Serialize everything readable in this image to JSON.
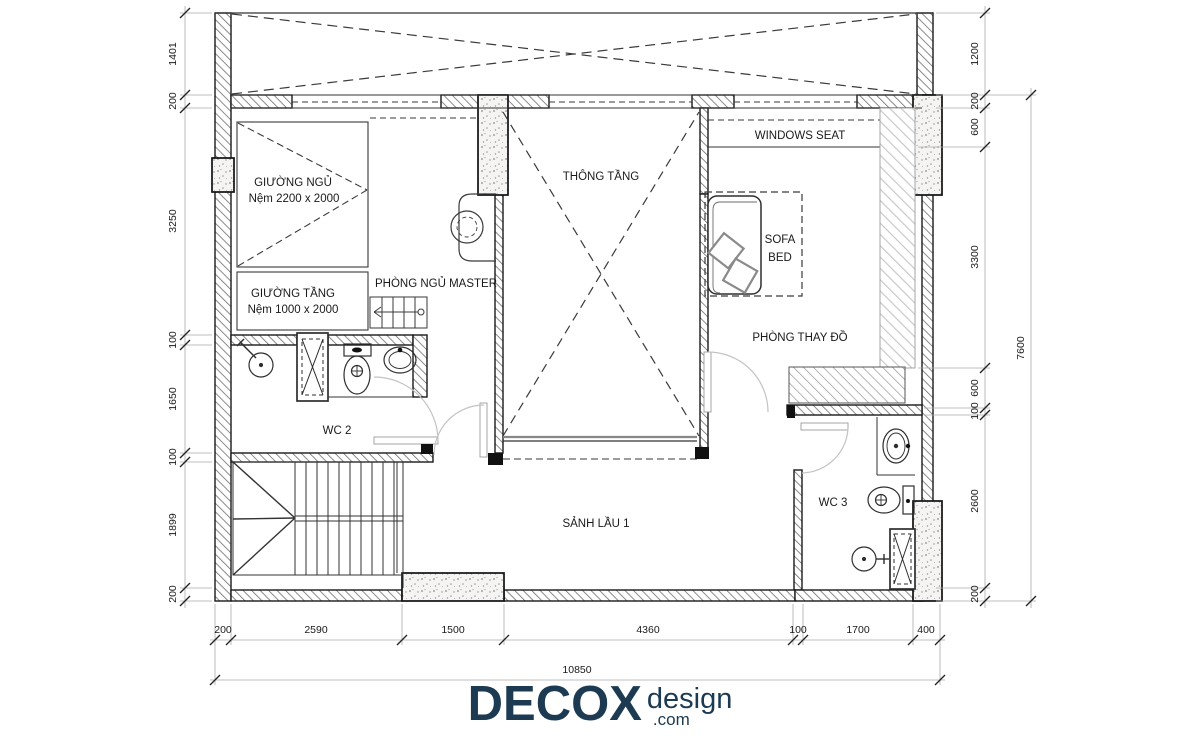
{
  "plan": {
    "rooms": {
      "master_bed": {
        "label": "GIƯỜNG NGỦ",
        "sub": "Nệm 2200 x 2000"
      },
      "bunk_bed": {
        "label": "GIƯỜNG TẦNG",
        "sub": "Nệm 1000 x 2000"
      },
      "master": {
        "label": "PHÒNG NGỦ MASTER"
      },
      "void": {
        "label": "THÔNG TẦNG"
      },
      "windows_seat": {
        "label": "WINDOWS SEAT"
      },
      "sofa_bed": {
        "line1": "SOFA",
        "line2": "BED"
      },
      "dressing": {
        "label": "PHÒNG THAY ĐỒ"
      },
      "wc2": {
        "label": "WC 2"
      },
      "wc3": {
        "label": "WC 3"
      },
      "hall": {
        "label": "SẢNH LẦU 1"
      }
    },
    "dimensions": {
      "left": [
        "1401",
        "200",
        "3250",
        "100",
        "1650",
        "100",
        "1899",
        "200"
      ],
      "right": [
        "1200",
        "200",
        "600",
        "3300",
        "600",
        "100",
        "2600",
        "200"
      ],
      "right_total": "7600",
      "bottom": [
        "200",
        "2590",
        "1500",
        "4360",
        "100",
        "1700",
        "400"
      ],
      "bottom_total": "10850"
    }
  },
  "logo": {
    "brand": "DECOX",
    "suffix": "design",
    "tld": ".com"
  },
  "colors": {
    "ink": "#1a1a1a",
    "brand_navy": "#1c3a52",
    "dim_line": "#9a9a9a"
  }
}
